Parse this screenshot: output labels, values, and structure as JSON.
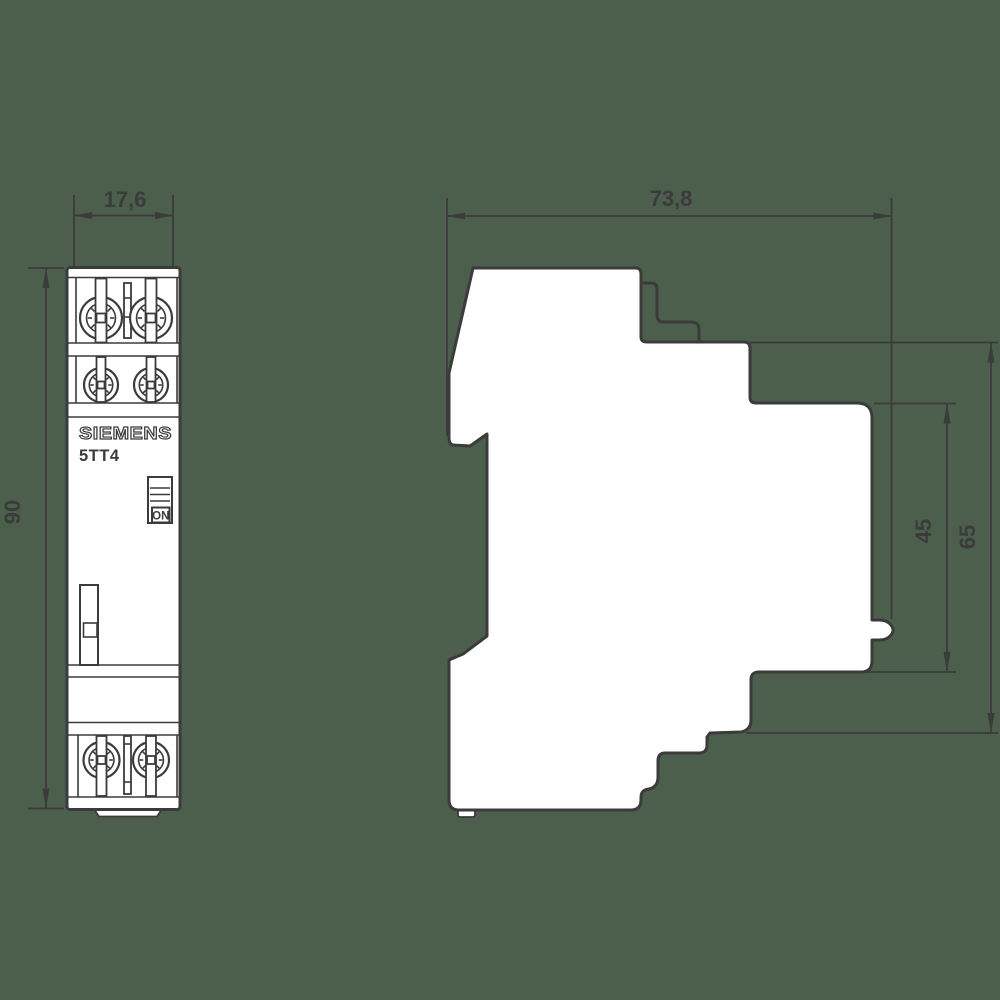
{
  "colors": {
    "background": "#4c5e4c",
    "line": "#3b3b3b",
    "surface": "#ffffff"
  },
  "device": {
    "brand": "SIEMENS",
    "model": "5TT4",
    "switch_label": "ON"
  },
  "dimensions_mm": {
    "width": "17,6",
    "height": "90",
    "depth": "73,8",
    "rail_offset": "45",
    "body_depth": "65"
  }
}
